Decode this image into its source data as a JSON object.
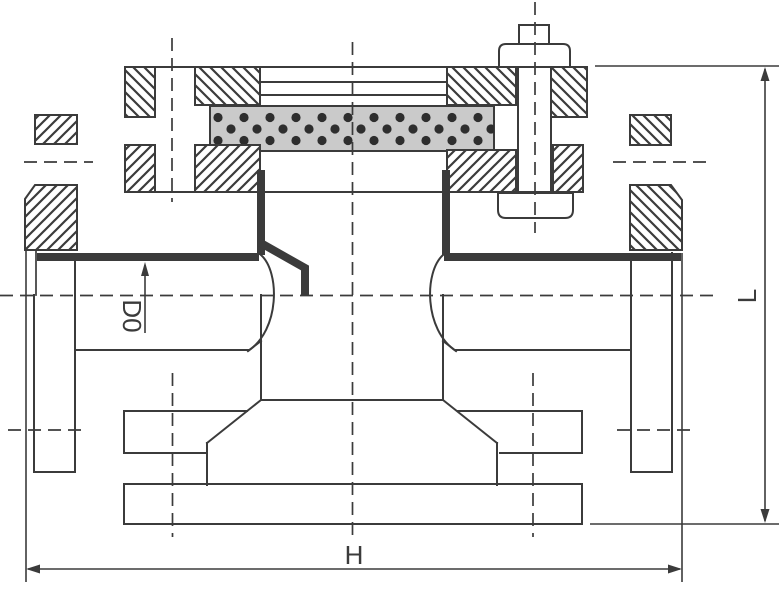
{
  "labels": {
    "dim_d0": "D0",
    "dim_h": "H",
    "dim_l": "L"
  },
  "colors": {
    "line": "#3b3b3b",
    "filter_media_fill": "#cacaca",
    "filter_media_dot": "#2e2e2e",
    "background": "#ffffff"
  }
}
